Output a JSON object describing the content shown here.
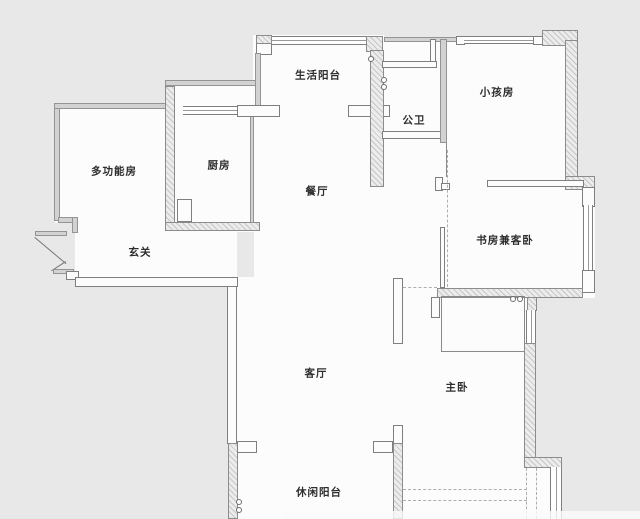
{
  "canvas": {
    "background_color": "#e8e8e8",
    "floor_color": "#fcfcfc",
    "wall_outline_color": "#7f7f7f"
  },
  "rooms": [
    {
      "label": "生活阳台"
    },
    {
      "label": "公卫"
    },
    {
      "label": "小孩房"
    },
    {
      "label": "多功能房"
    },
    {
      "label": "厨房"
    },
    {
      "label": "餐厅"
    },
    {
      "label": "玄关"
    },
    {
      "label": "书房兼客卧"
    },
    {
      "label": "客厅"
    },
    {
      "label": "主卧"
    },
    {
      "label": "休闲阳台"
    }
  ]
}
